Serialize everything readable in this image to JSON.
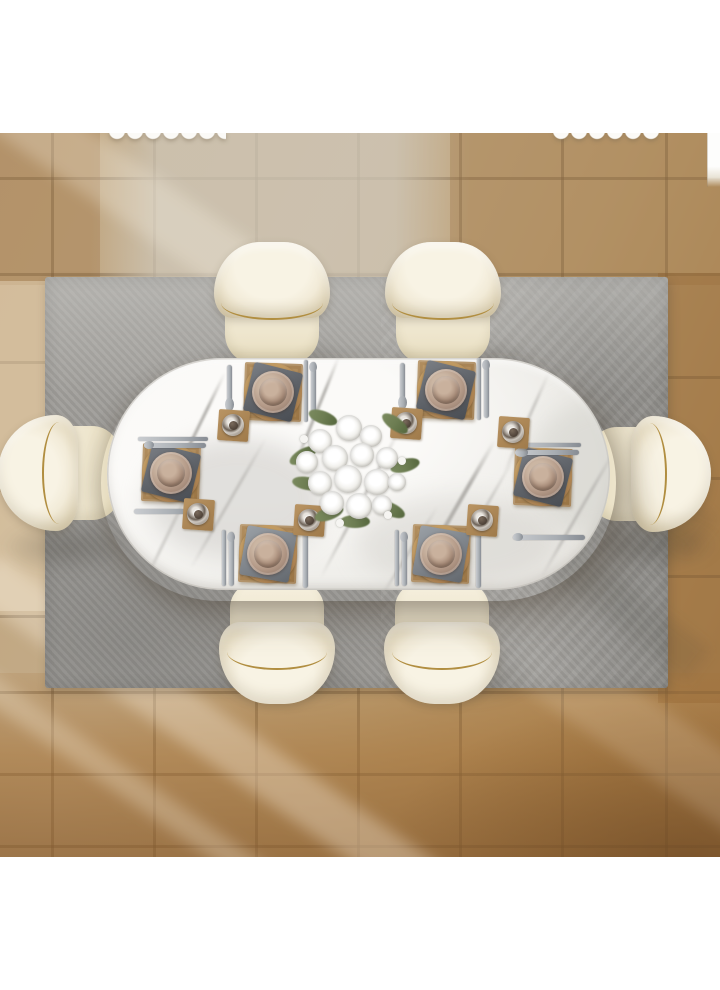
{
  "meta": {
    "image_type": "product-photo",
    "view": "top-down"
  },
  "scene": {
    "background_color": "#ffffff",
    "floor": {
      "material": "terracotta-tile",
      "tile_colors": [
        "#c6bba7",
        "#b3916a",
        "#ad8049"
      ],
      "grout_color": "#6d563a",
      "lighting": "diagonal window light beams from left"
    },
    "rug": {
      "color": "#a2a09c",
      "light_edge": "#bcbab6",
      "dark_corner": "#8d8b86"
    },
    "table": {
      "shape": "oval",
      "top_color": "#f6f5f2",
      "vein_color": "#b2b0ac",
      "material": "white marble"
    },
    "chairs": {
      "count": 6,
      "upholstery": "#f2ebd8",
      "trim": "#b18e40"
    },
    "place_settings": {
      "count": 6,
      "placemat": "#b08c5c",
      "charger": "#a87d4e",
      "plate": "#b49a88",
      "napkin": "#5d6167",
      "cutlery": "#a9aeb3",
      "glass_coaster": "#b99463"
    },
    "centerpiece": {
      "type": "white-rose-bouquet",
      "flower_color": "#f2f1ed",
      "foliage_color": "#6d7d52"
    },
    "curtain_fragments": 2
  }
}
